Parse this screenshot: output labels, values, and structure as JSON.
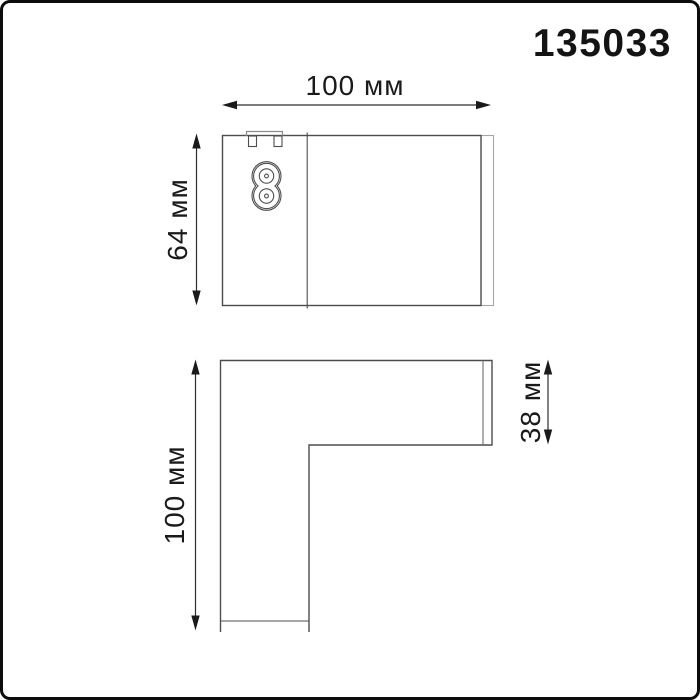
{
  "product_code": "135033",
  "unit": "мм",
  "dimensions": {
    "top_view": {
      "width_label": "100 мм",
      "height_label": "64 мм"
    },
    "front_view": {
      "height_label": "100 мм",
      "profile_label": "38 мм"
    }
  },
  "colors": {
    "background": "#ffffff",
    "frame_border": "#0c0c0c",
    "drawing_line": "#4d4d4d",
    "light_line": "#a6a6a6",
    "dimension_line": "#2e2e2e",
    "text": "#1a1a1a"
  },
  "icons": {
    "connector": "figure8-power-socket-icon",
    "clip": "mount-clip-icon",
    "arrows": "dimension-arrow-icon"
  }
}
